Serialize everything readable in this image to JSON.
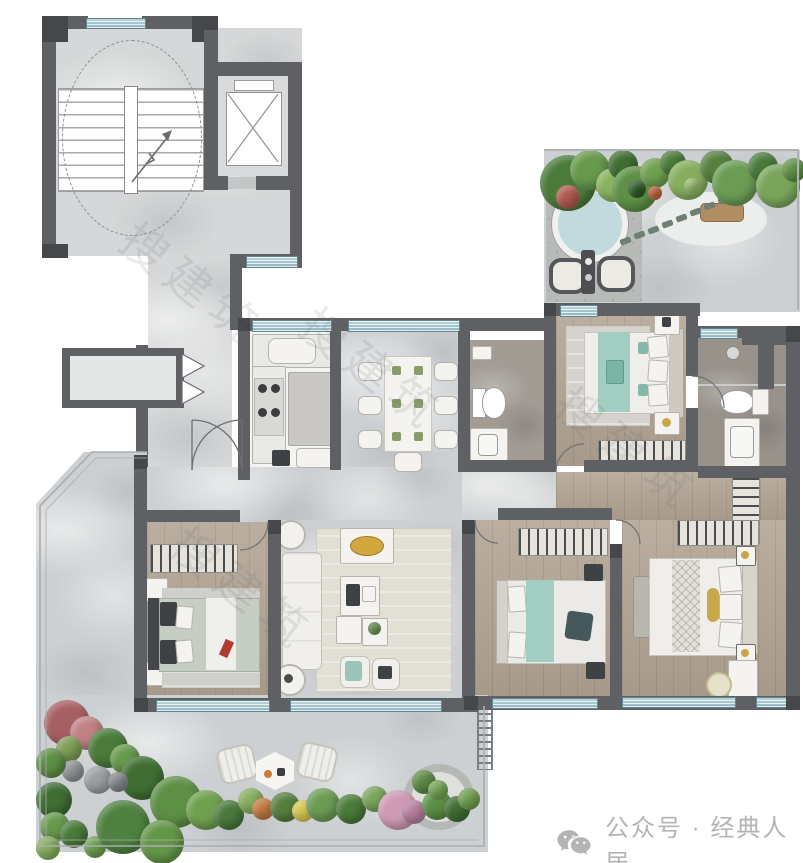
{
  "watermark": {
    "text": "搜建筑"
  },
  "credit": {
    "icon": "wechat-icon",
    "text": "公众号 · 经典人居"
  },
  "palette": {
    "wall": "#5e6063",
    "wall_dark": "#45474b",
    "window_teal": "#9fc3cc",
    "marble_floor": "#cdd0d2",
    "wood_floor": "#b1a393",
    "kitchen_floor": "#f3f3f1",
    "bath_floor": "#98928b",
    "rug": "#e2dfd5",
    "bedding_teal": "#a2cdc1",
    "bedding_sage": "#c6cdc2",
    "accent_gold": "#d2a83e",
    "accent_red": "#b23a32",
    "plant_green": "#5d8f45",
    "credit_text": "#b4b4b6"
  }
}
